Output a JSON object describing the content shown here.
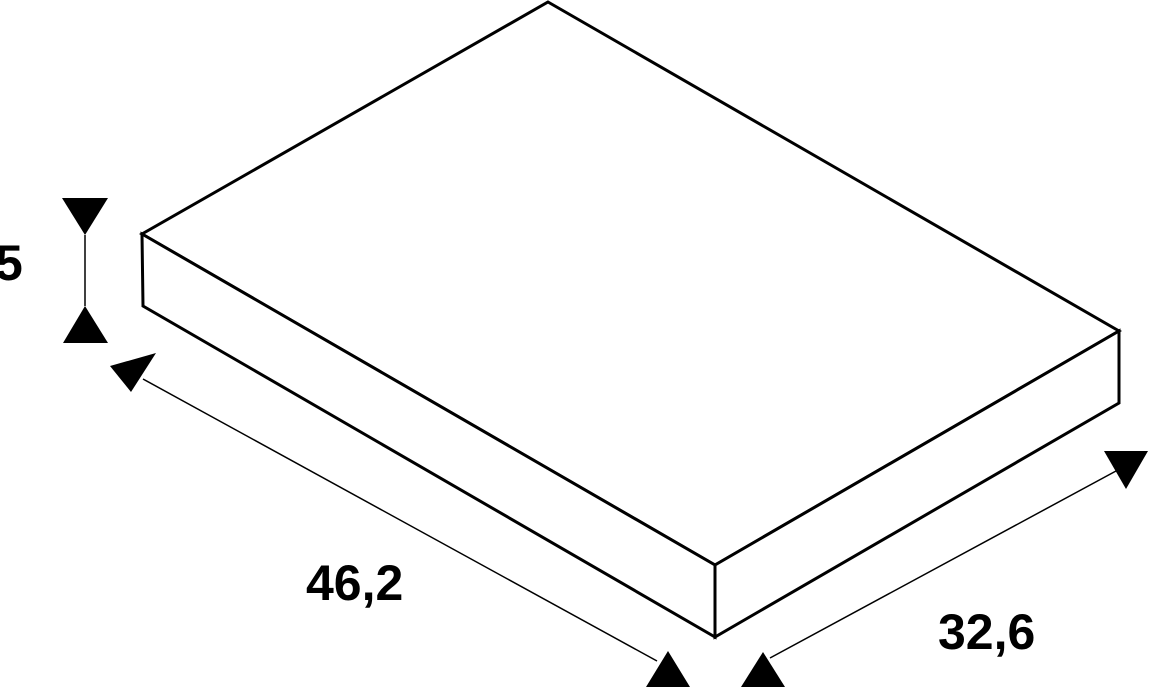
{
  "canvas": {
    "width": 1150,
    "height": 688,
    "background_color": "#ffffff",
    "line_color": "#000000"
  },
  "figure": {
    "type": "isometric-dimension-drawing",
    "object": "flat rectangular plate",
    "dimensions": {
      "height": {
        "label": "5",
        "value": 5
      },
      "length": {
        "label": "46,2",
        "value": 46.2
      },
      "width": {
        "label": "32,6",
        "value": 32.6
      }
    }
  },
  "geometry": {
    "slab_stroke_width": 3,
    "dimension_stroke_width": 1.5,
    "faces": [
      {
        "name": "slab-top-face",
        "points": [
          [
            548,
            2
          ],
          [
            1119,
            331
          ],
          [
            715,
            565
          ],
          [
            142,
            234
          ]
        ]
      },
      {
        "name": "slab-left-face",
        "points": [
          [
            142,
            234
          ],
          [
            715,
            565
          ],
          [
            715,
            637
          ],
          [
            143,
            306
          ]
        ]
      },
      {
        "name": "slab-right-face",
        "points": [
          [
            715,
            565
          ],
          [
            1119,
            331
          ],
          [
            1119,
            403
          ],
          [
            715,
            637
          ]
        ]
      }
    ],
    "dimension_lines": [
      {
        "name": "height-dimension-line",
        "x1": 85,
        "y1": 235,
        "x2": 85,
        "y2": 306
      },
      {
        "name": "length-dimension-line",
        "x1": 143,
        "y1": 379,
        "x2": 657,
        "y2": 661
      },
      {
        "name": "width-dimension-line",
        "x1": 770,
        "y1": 658,
        "x2": 1116,
        "y2": 471
      }
    ],
    "arrowheads": [
      {
        "name": "height-arrow-top-icon",
        "direction": "down",
        "points": [
          [
            62,
            198
          ],
          [
            108,
            198
          ],
          [
            85,
            235
          ]
        ]
      },
      {
        "name": "height-arrow-bottom-icon",
        "direction": "up",
        "points": [
          [
            63,
            343
          ],
          [
            108,
            343
          ],
          [
            85,
            306
          ]
        ]
      },
      {
        "name": "length-arrow-start-icon",
        "direction": "down",
        "points": [
          [
            110,
            366
          ],
          [
            156,
            353
          ],
          [
            131,
            392
          ]
        ]
      },
      {
        "name": "length-arrow-end-icon",
        "direction": "up",
        "points": [
          [
            646,
            687
          ],
          [
            690,
            687
          ],
          [
            668,
            651
          ]
        ]
      },
      {
        "name": "width-arrow-start-icon",
        "direction": "up",
        "points": [
          [
            741,
            687
          ],
          [
            785,
            687
          ],
          [
            763,
            652
          ]
        ]
      },
      {
        "name": "width-arrow-end-icon",
        "direction": "down",
        "points": [
          [
            1104,
            451
          ],
          [
            1148,
            451
          ],
          [
            1126,
            489
          ]
        ]
      }
    ]
  }
}
